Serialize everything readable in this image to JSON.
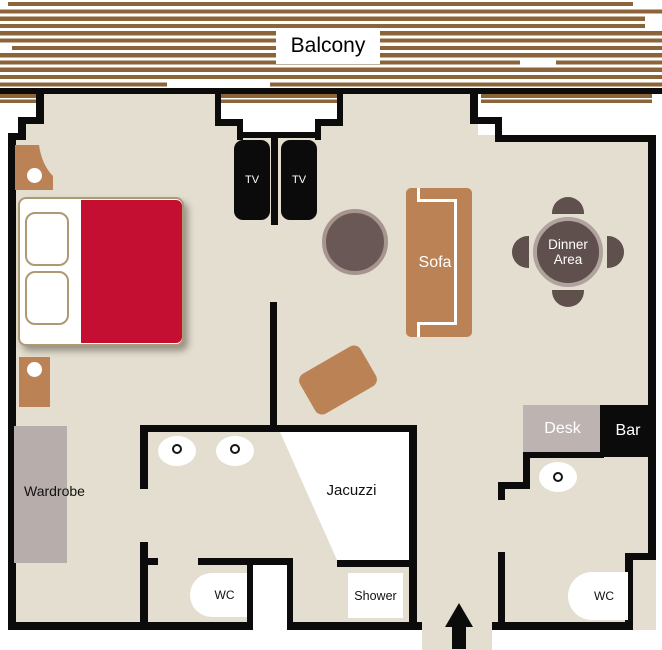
{
  "colors": {
    "wall": "#0b0b0b",
    "floor": "#e3decf",
    "wood": "#8c6439",
    "brown": "#bb8255",
    "red": "#c40e32",
    "trim": "#ad9a74",
    "desk": "#bdb4b1",
    "wardrobe": "#b7adaa",
    "table": "#5f4f4d",
    "ring": "#b0a29d",
    "coffee": "#6a5856",
    "coffeering": "#a6958f"
  },
  "balcony": {
    "label": "Balcony"
  },
  "living": {
    "tv_left": "TV",
    "tv_right": "TV",
    "sofa": "Sofa",
    "dinner_line1": "Dinner",
    "dinner_line2": "Area",
    "desk": "Desk",
    "bar": "Bar"
  },
  "bedroom": {
    "wardrobe": "Wardrobe"
  },
  "bathroom": {
    "jacuzzi": "Jacuzzi",
    "shower": "Shower",
    "wc": "WC"
  },
  "hall": {
    "wc": "WC"
  }
}
